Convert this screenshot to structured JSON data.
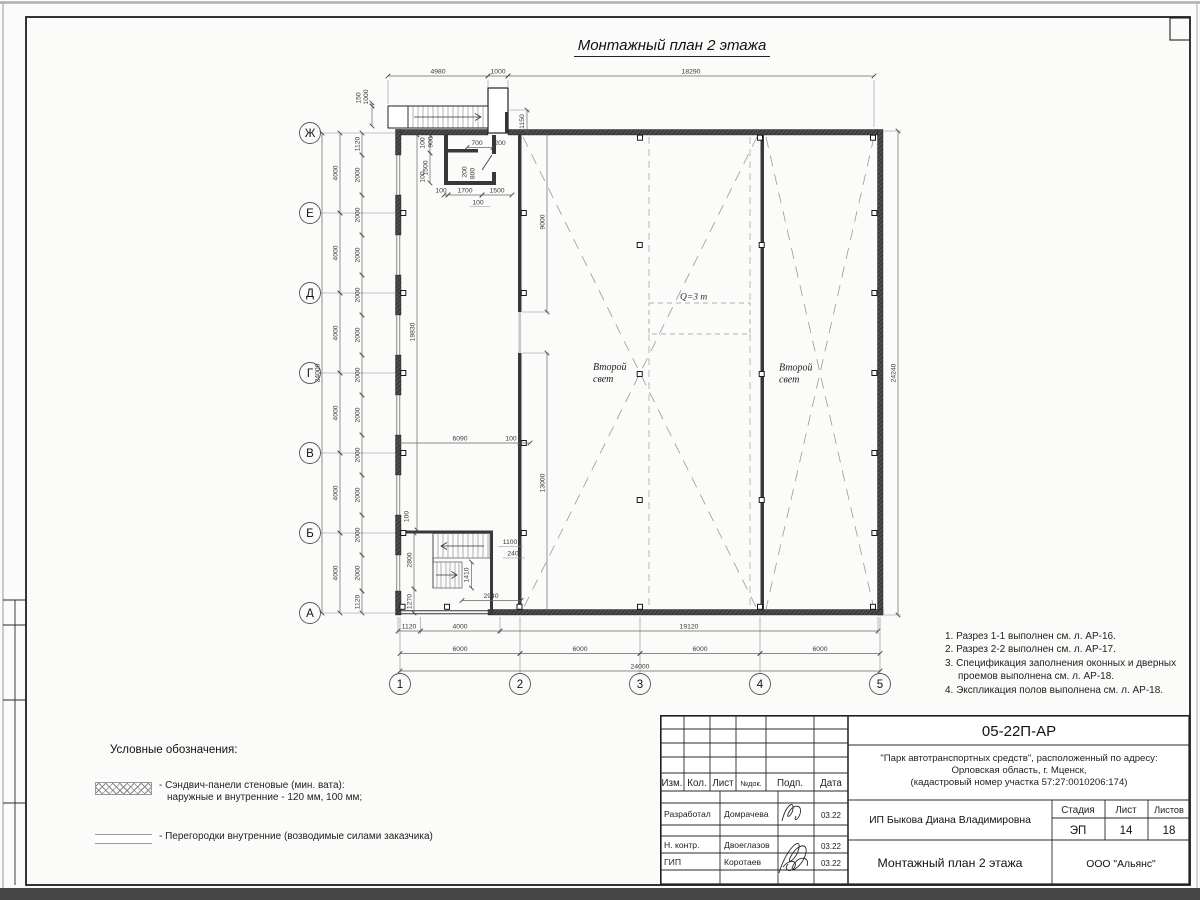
{
  "sheet": {
    "title": "Монтажный план 2 этажа"
  },
  "plan": {
    "axes_rows": [
      "Ж",
      "Е",
      "Д",
      "Г",
      "В",
      "Б",
      "А"
    ],
    "axes_cols": [
      "1",
      "2",
      "3",
      "4",
      "5"
    ],
    "labels": {
      "void_left_line1": "Второй",
      "void_left_line2": "свет",
      "void_right_line1": "Второй",
      "void_right_line2": "свет",
      "crane": "Q=3 т"
    }
  },
  "dims": {
    "top": [
      "4980",
      "1000",
      "18290"
    ],
    "top_left": {
      "d150": "150",
      "d1000": "1000",
      "d1150": "1150"
    },
    "left_outer": "24000",
    "left_mid": [
      "4000",
      "4000",
      "4000",
      "4000",
      "4000",
      "4000"
    ],
    "left_inner": [
      "1120",
      "2000",
      "2000",
      "2000",
      "2000",
      "2000",
      "2000",
      "2000",
      "2000",
      "2000",
      "2000",
      "2000",
      "1120"
    ],
    "right_total": "24240",
    "bottom_first": [
      "1120",
      "4000",
      "19120"
    ],
    "bottom_axes": [
      "6000",
      "6000",
      "6000",
      "6000"
    ],
    "bottom_total": "24000",
    "interior": {
      "corridor": "19830",
      "upper": "9000",
      "lower": "13000",
      "d6090": "6090",
      "d100": "100",
      "wall100": "100"
    },
    "shaft_top": [
      "700",
      "200"
    ],
    "shaft_left": [
      "100",
      "900",
      "1500",
      "100"
    ],
    "shaft_inner": [
      "200",
      "800"
    ],
    "shaft_bottom": [
      "100",
      "1700",
      "1500",
      "100"
    ],
    "stair": {
      "d2800": "2800",
      "d1270": "1270",
      "d1100": "1100",
      "d240": "240",
      "d1410": "1410",
      "d2940": "2940"
    }
  },
  "notes": {
    "items": [
      "1. Разрез 1-1 выполнен см. л. АР-16.",
      "2. Разрез 2-2 выполнен см. л. АР-17.",
      "3. Спецификация заполнения оконных и дверных проемов выполнена см. л. АР-18.",
      "4. Экспликация полов выполнена см. л. АР-18."
    ]
  },
  "legend": {
    "title": "Условные обозначения:",
    "item1_line1": "- Сэндвич-панели стеновые (мин. вата):",
    "item1_line2": "наружные и внутренние - 120 мм, 100 мм;",
    "item2": "- Перегородки внутренние (возводимые силами заказчика)"
  },
  "titleblock": {
    "doc_number": "05-22П-АР",
    "project_line1": "\"Парк автотранспортных средств\",  расположенный по адресу:",
    "project_line2": "Орловская область, г. Мценск,",
    "project_line3": "(кадастровый номер участка 57:27:0010206:174)",
    "rev_header": {
      "izm": "Изм.",
      "kol": "Кол.",
      "list": "Лист",
      "ndok": "№док.",
      "podp": "Подп.",
      "data": "Дата"
    },
    "roles": [
      {
        "role": "Разработал",
        "name": "Домрачева",
        "date": "03.22"
      },
      {
        "role": "Н. контр.",
        "name": "Двоеглазов",
        "date": "03.22"
      },
      {
        "role": "ГИП",
        "name": "Коротаев",
        "date": "03.22"
      }
    ],
    "client": "ИП Быкова Диана Владимировна",
    "stage_label": "Стадия",
    "sheet_label": "Лист",
    "sheets_label": "Листов",
    "stage": "ЭП",
    "sheet": "14",
    "sheets": "18",
    "drawing_title": "Монтажный план 2 этажа",
    "company": "ООО \"Альянс\""
  }
}
